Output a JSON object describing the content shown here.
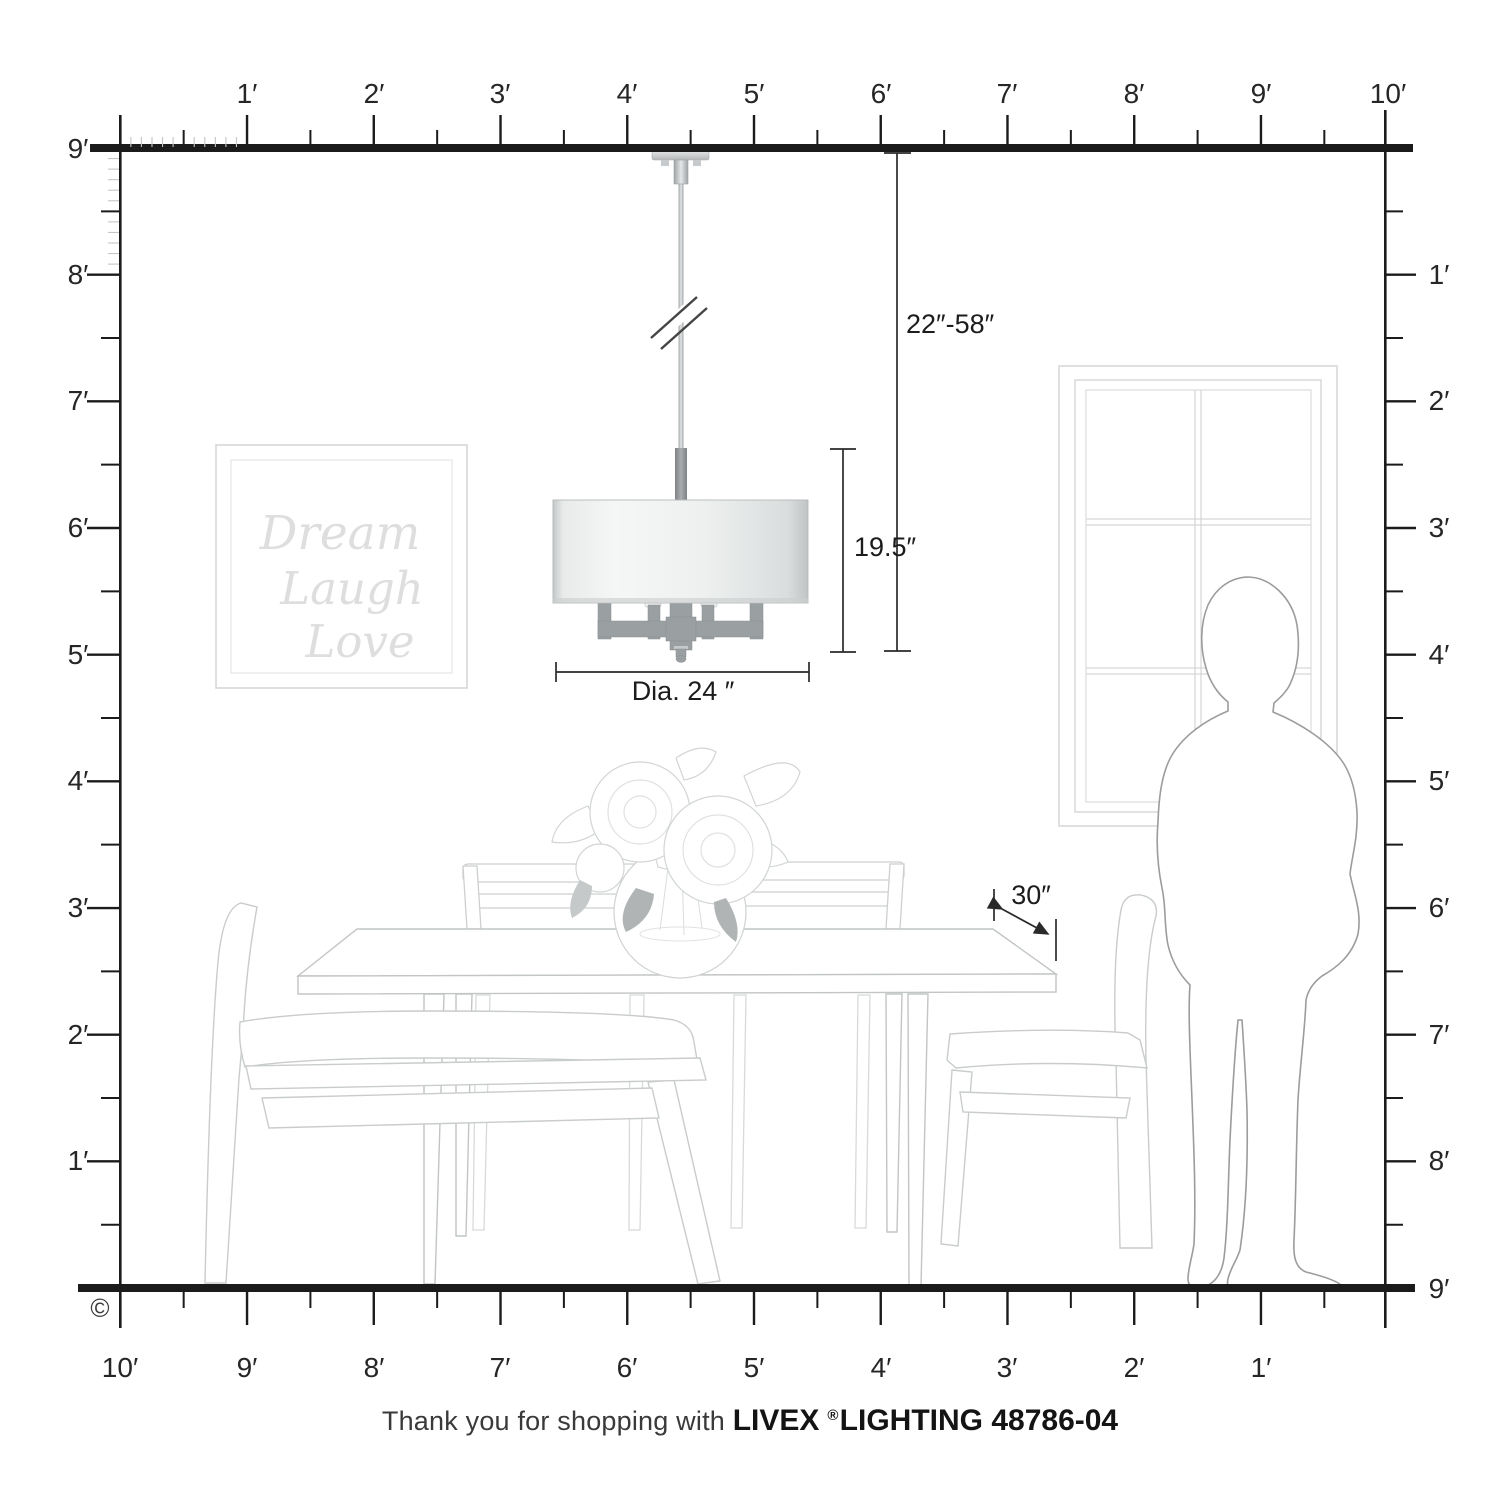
{
  "rulers": {
    "top": [
      "1′",
      "2′",
      "3′",
      "4′",
      "5′",
      "6′",
      "7′",
      "8′",
      "9′",
      "10′"
    ],
    "left": [
      "9′",
      "8′",
      "7′",
      "6′",
      "5′",
      "4′",
      "3′",
      "2′",
      "1′"
    ],
    "right": [
      "1′",
      "2′",
      "3′",
      "4′",
      "5′",
      "6′",
      "7′",
      "8′",
      "9′"
    ],
    "bottom": [
      "10′",
      "9′",
      "8′",
      "7′",
      "6′",
      "5′",
      "4′",
      "3′",
      "2′",
      "1′"
    ]
  },
  "dimensions": {
    "hanging_range": "22″-58″",
    "shade_height": "19.5″",
    "shade_diameter": "Dia. 24 ″",
    "wall_clearance": "30″"
  },
  "wall_art": {
    "line1": "Dream",
    "line2": "Laugh",
    "line3": "Love"
  },
  "footer": {
    "prefix": "Thank you for shopping with",
    "brand": "LIVEX",
    "registered": "®",
    "product": "LIGHTING 48786-04"
  },
  "copyright": "©",
  "colors": {
    "ruler_line": "#1b1b1b",
    "ruler_text": "#262626",
    "inch_tick": "#c5c5c5",
    "furniture_line": "#c9cccc",
    "person_line": "#9c9c9c",
    "metal_arm": "#9aa0a2",
    "shade_light": "#f5f6f6",
    "shade_dark": "#c4c8c8"
  }
}
